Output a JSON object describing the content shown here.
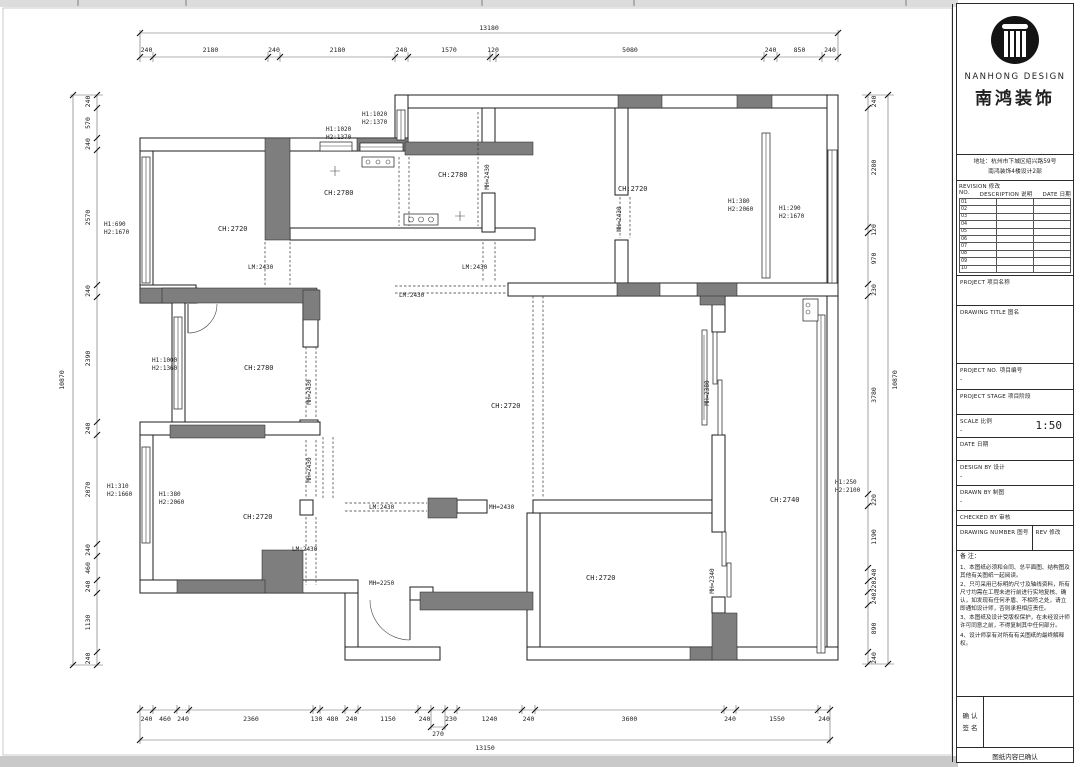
{
  "title_block": {
    "brand_en": "NANHONG DESIGN",
    "brand_cn": "南鸿装饰",
    "address_l1": "地址：杭州市下城区绍兴路59号",
    "address_l2": "南鸿装饰4楼设计2部",
    "revision_title": "REVISION  修改",
    "col_no": "NO.",
    "col_desc": "DESCRIPTION 说明",
    "col_date": "DATE 日期",
    "revision_rows": [
      "01",
      "02",
      "03",
      "04",
      "05",
      "06",
      "07",
      "08",
      "09",
      "10"
    ],
    "project_label": "PROJECT  项目名称",
    "drawing_title_label": "DRAWING TITLE  图名",
    "project_no_label": "PROJECT NO.  项目编号",
    "project_no_value": "-",
    "project_stage_label": "PROJECT STAGE  项目阶段",
    "scale_label": "SCALE  比例",
    "scale_dash": "-",
    "scale_value": "1:50",
    "date_label": "DATE  日期",
    "design_by_label": "DESIGN BY  设计",
    "design_by_value": "-",
    "drawn_by_label": "DRAWN BY  制图",
    "drawn_by_value": "-",
    "checked_by_label": "CHECKED BY  审核",
    "drawing_number_label": "DRAWING NUMBER  图号",
    "rev_label": "REV  修改",
    "notes_title": "备 注：",
    "notes": [
      "1、本图纸必须和合同、总平面图、结构图及其他有关图纸一起阅读。",
      "2、只可采用已标明的尺寸及轴线资料，所有尺寸均需在工程未进行前进行实地复核、确认，如发现有任何矛盾、不相符之处，请立即通知设计师，否则承担相应责任。",
      "3、本图纸及设计受版权保护，在未经设计师许可同意之前，不得复制其中任何部分。",
      "4、设计师享有对所有有关图纸的最终解释权。"
    ],
    "confirm_l1": "确 认",
    "confirm_l2": "签 名",
    "confirm_note": "图纸内容已确认"
  },
  "dims": {
    "top": {
      "total": "13180",
      "segments": [
        "240",
        "2180",
        "240",
        "2180",
        "240",
        "1570",
        "120",
        "5080",
        "240",
        "850",
        "240"
      ]
    },
    "left": {
      "total": "10870",
      "segments": [
        "240",
        "570",
        "240",
        "2570",
        "240",
        "2390",
        "240",
        "2070",
        "240",
        "460",
        "240",
        "1130",
        "240"
      ]
    },
    "right": {
      "total": "10870",
      "segments": [
        "240",
        "2280",
        "120",
        "970",
        "230",
        "3780",
        "220",
        "1190",
        "240",
        "220",
        "240",
        "890",
        "240"
      ]
    },
    "bottom": {
      "total": "13150",
      "sub": "270",
      "segments": [
        "240",
        "460",
        "240",
        "2360",
        "130",
        "480",
        "240",
        "1150",
        "240",
        "230",
        "1240",
        "240",
        "3600",
        "240",
        "1550",
        "240"
      ]
    }
  },
  "rooms": [
    {
      "label": "CH:2720"
    },
    {
      "label": "CH:2780"
    },
    {
      "label": "CH:2780"
    },
    {
      "label": "CH:2720"
    },
    {
      "label": "CH:2780"
    },
    {
      "label": "CH:2720"
    },
    {
      "label": "CH:2720"
    },
    {
      "label": "CH:2740"
    },
    {
      "label": "CH:2720"
    }
  ],
  "window_labels": [
    {
      "l1": "H1:1020",
      "l2": "H2:1370"
    },
    {
      "l1": "H1:1020",
      "l2": "H2:1370"
    },
    {
      "l1": "H1:690",
      "l2": "H2:1670"
    },
    {
      "l1": "H1:1000",
      "l2": "H2:1360"
    },
    {
      "l1": "H1:310",
      "l2": "H2:1660"
    },
    {
      "l1": "H1:380",
      "l2": "H2:2060"
    },
    {
      "l1": "H1:380",
      "l2": "H2:2060"
    },
    {
      "l1": "H1:290",
      "l2": "H2:1670"
    },
    {
      "l1": "H1:250",
      "l2": "H2:2100"
    }
  ],
  "openings": [
    {
      "label": "LM:2430"
    },
    {
      "label": "LM:2430"
    },
    {
      "label": "LM:2430"
    },
    {
      "label": "MH=2430"
    },
    {
      "label": "MH=2430"
    },
    {
      "label": "MH=2430"
    },
    {
      "label": "LM:2430"
    },
    {
      "label": "MH=2430"
    },
    {
      "label": "LM:2430"
    },
    {
      "label": "MH=2250"
    },
    {
      "label": "MH=2380"
    },
    {
      "label": "MH=2340"
    },
    {
      "label": "MH=2430"
    }
  ]
}
